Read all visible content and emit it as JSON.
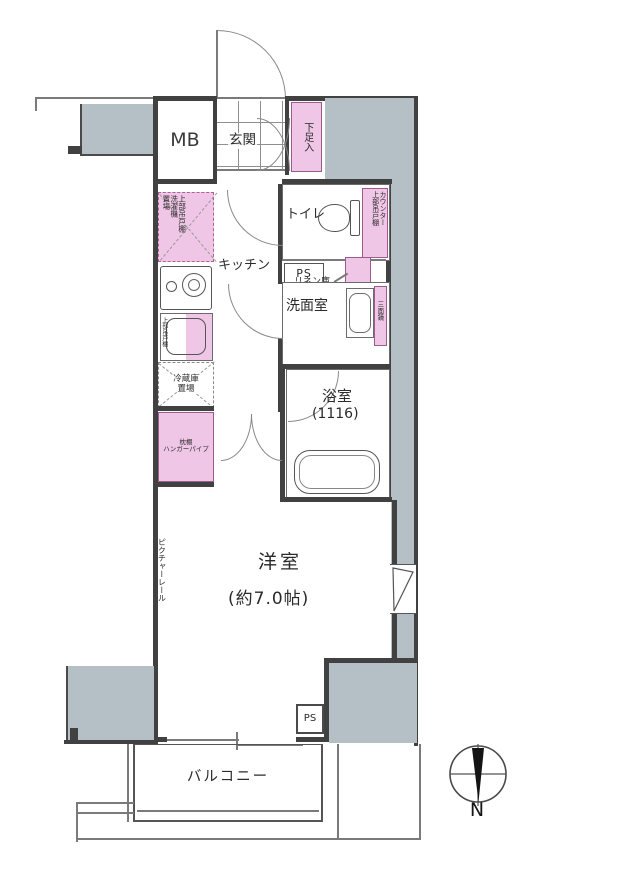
{
  "colors": {
    "outside_gray": "#b5bfc6",
    "storage_pink": "#efc6e6",
    "wall": "#414141"
  },
  "plan": {
    "mb": "MB",
    "genkan": "玄関",
    "shoe_box": "下足入",
    "toilet": "トイレ",
    "toilet_shelf_col1": "カウンター",
    "toilet_shelf_col2": "上部吊戸棚",
    "ps_top": "PS",
    "linen": "リネン庫",
    "washroom": "洗面室",
    "mirror": "三面鏡",
    "bathroom": "浴室",
    "bathroom_size": "(1116)",
    "laundry_col1": "上部吊戸棚",
    "laundry_col2": "洗濯機",
    "laundry_col3": "置場",
    "kitchen": "キッチン",
    "sink_shelf": "上部吊戸棚",
    "fridge_line1": "冷蔵庫",
    "fridge_line2": "置場",
    "closet_line1": "枕棚",
    "closet_line2": "ハンガーパイプ",
    "bedroom": "洋室",
    "bedroom_size": "(約7.0帖)",
    "picture_rail": "ピクチャーレール",
    "ps_bottom": "PS",
    "balcony": "バルコニー",
    "compass_north": "N"
  }
}
